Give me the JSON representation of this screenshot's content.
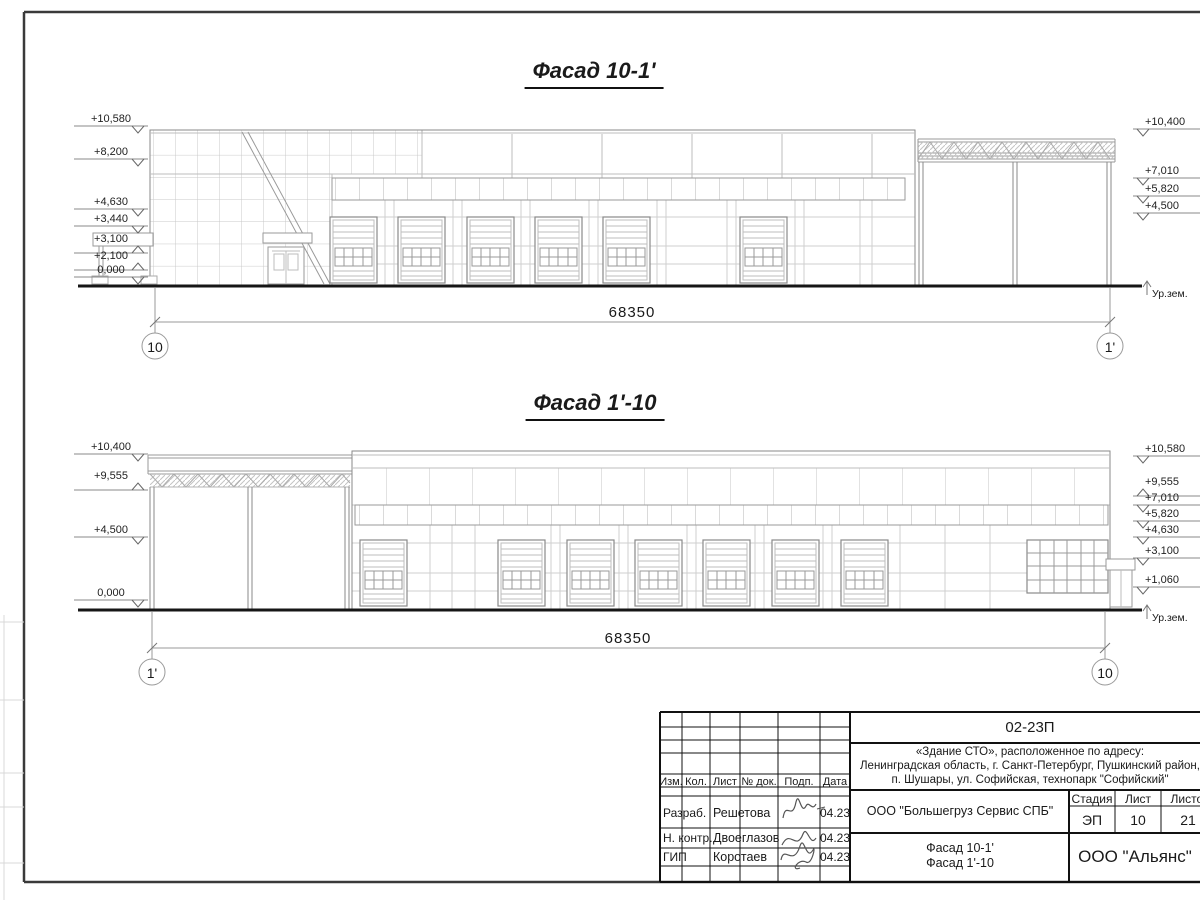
{
  "facade1": {
    "title": "Фасад 10-1'",
    "dimension": "68350",
    "axis_left": "10",
    "axis_right": "1'",
    "ground_label": "Ур.зем.",
    "left_marks": [
      "+10,580",
      "+8,200",
      "+4,630",
      "+3,440",
      "+3,100",
      "+2,100",
      "0,000"
    ],
    "right_marks": [
      "+10,400",
      "+7,010",
      "+5,820",
      "+4,500"
    ]
  },
  "facade2": {
    "title": "Фасад 1'-10",
    "dimension": "68350",
    "axis_left": "1'",
    "axis_right": "10",
    "ground_label": "Ур.зем.",
    "left_marks": [
      "+10,400",
      "+9,555",
      "+4,500",
      "0,000"
    ],
    "right_marks": [
      "+10,580",
      "+9,555",
      "+7,010",
      "+5,820",
      "+4,630",
      "+3,100",
      "+1,060"
    ]
  },
  "title_block": {
    "doc_number": "02-23П",
    "address_line1": "«Здание СТО», расположенное по адресу:",
    "address_line2": "Ленинградская область, г. Санкт-Петербург, Пушкинский район,",
    "address_line3": "п. Шушары, ул. Софийская, технопарк \"Софийский\"",
    "cols": [
      "Изм.",
      "Кол.",
      "Лист",
      "№ док.",
      "Подп.",
      "Дата"
    ],
    "rows": [
      {
        "role": "Разраб.",
        "name": "Решетова",
        "date": "04.23"
      },
      {
        "role": "Н. контр.",
        "name": "Двоеглазов",
        "date": "04.23"
      },
      {
        "role": "ГИП",
        "name": "Коротаев",
        "date": "04.23"
      }
    ],
    "company": "ООО \"Большегруз Сервис СПБ\"",
    "stage_label": "Стадия",
    "sheet_label": "Лист",
    "sheets_label": "Листов",
    "stage": "ЭП",
    "sheet_no": "10",
    "sheets_total": "21",
    "drawing_name_line1": "Фасад 10-1'",
    "drawing_name_line2": "Фасад 1'-10",
    "org": "ООО \"Альянс\""
  }
}
